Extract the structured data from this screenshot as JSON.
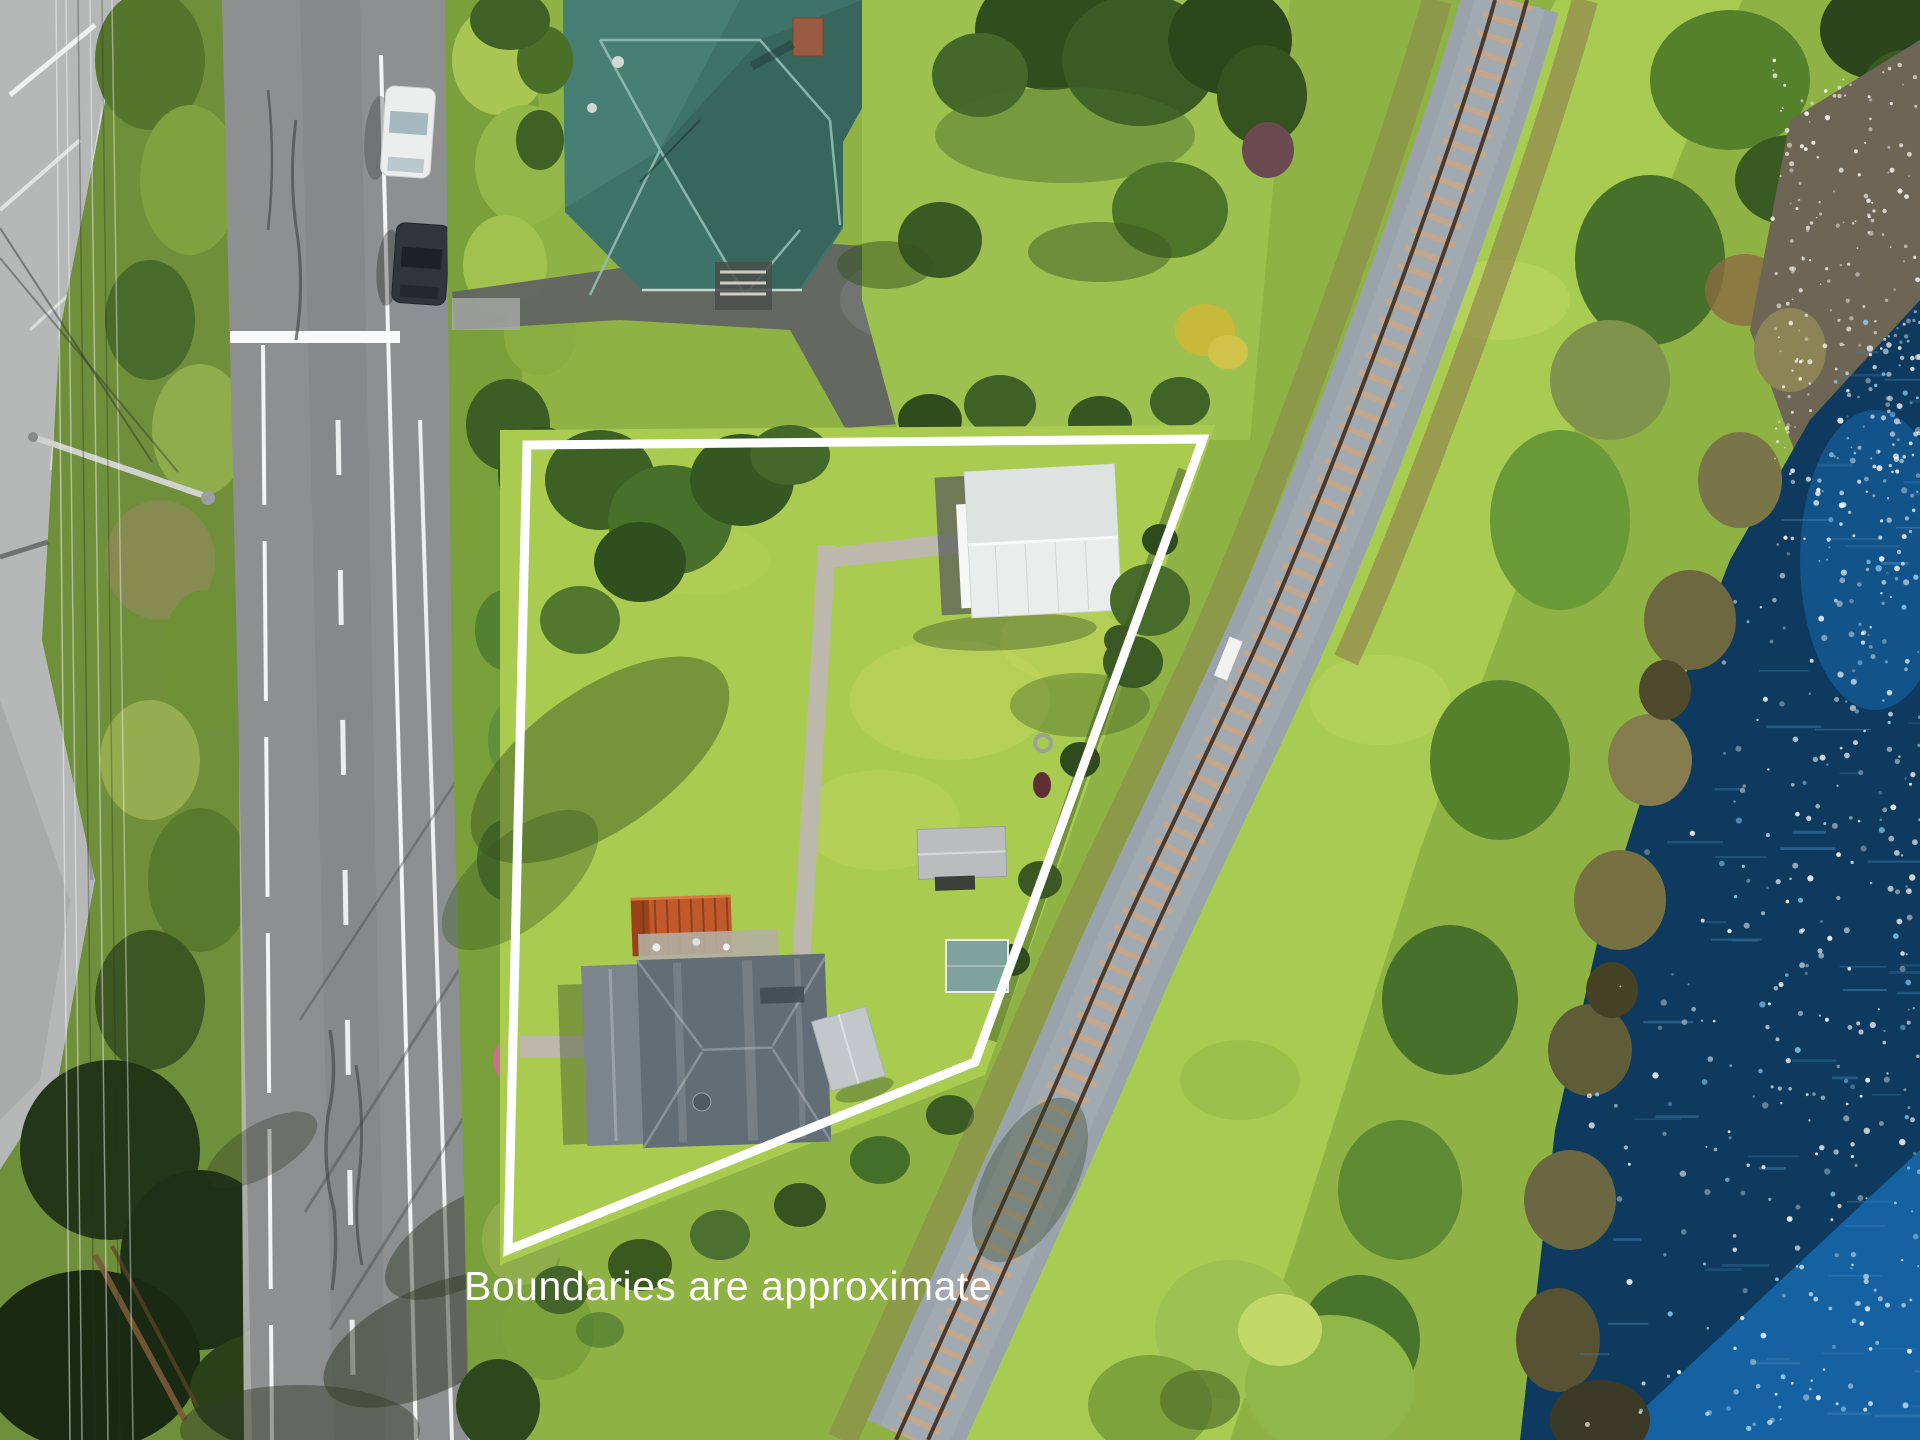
{
  "scene": {
    "kind": "aerial-drone-photo",
    "objects": [
      "highway-offramp",
      "scrub-strip",
      "power-lines",
      "street-lamp",
      "main-road",
      "road-markings",
      "parked-white-car",
      "parked-dark-car",
      "roadside-hedge",
      "teal-roof-house",
      "driveway",
      "property-lawn",
      "garden-trees",
      "white-shed",
      "pergola-shed",
      "small-teal-shed",
      "gray-roof-house",
      "orange-carport",
      "side-shed",
      "satellite-dish",
      "concrete-paths",
      "railway-track",
      "railway-marker",
      "grass-bank",
      "shore-trees",
      "reed-bank",
      "rocky-shoal",
      "water",
      "sun-glints",
      "boundary-overlay",
      "caption"
    ]
  },
  "caption": {
    "text": "Boundaries are approximate"
  },
  "boundary": {
    "points": [
      [
        527,
        445
      ],
      [
        1203,
        439
      ],
      [
        975,
        1062
      ],
      [
        508,
        1250
      ]
    ],
    "stroke_width": 9
  },
  "palette": {
    "grass": "#8fb244",
    "lawn": "#a9cb50",
    "verge": "#6f8f3a",
    "road": "#8d8f90",
    "pale_road": "#b6b8b8",
    "path": "#b9b5aa",
    "hedge": "#7aa03c",
    "tree_dark": "#33521f",
    "gravel": "#9aa3ab",
    "rail": "#4b3a2d",
    "sleeper": "#c8a687",
    "water": "#0d3a5e",
    "water_bright": "#1e84dc",
    "sparkle": "#ffffff",
    "sparkle_blue": "#8fd4ff",
    "reed": "#7a7548",
    "shoal": "#6e6554",
    "roof_teal": "#3e736a",
    "roof_gray": "#636d75",
    "roof_white": "#e9edec",
    "carport": "#c05a2a",
    "shed_gray": "#c2c7c9",
    "boundary": "#ffffff",
    "caption": "#ffffff"
  },
  "effects": {
    "sparkle_count": 430,
    "streak_count": 55,
    "speckle_count": 170
  }
}
